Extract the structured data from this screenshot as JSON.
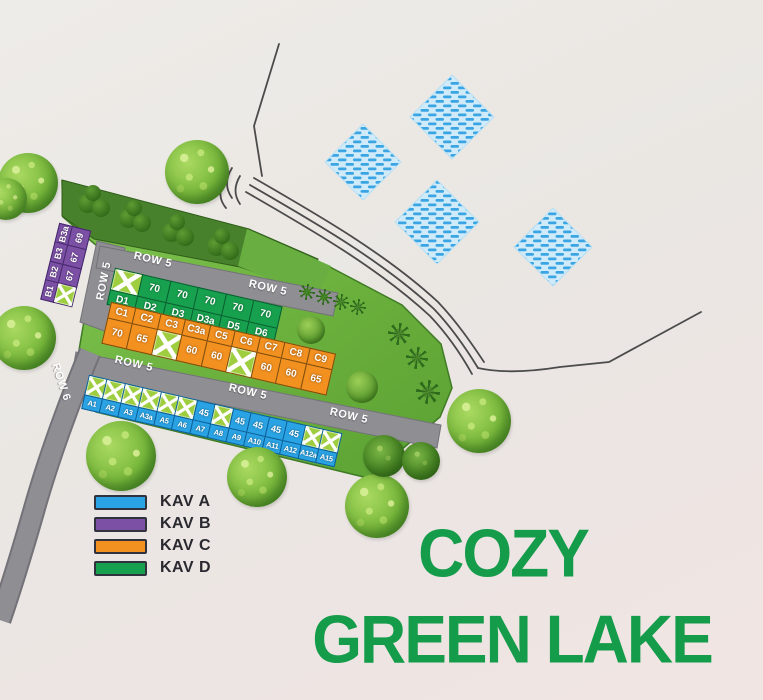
{
  "title": {
    "line1": "COZY",
    "line2": "GREEN LAKE",
    "color": "#159c4b"
  },
  "legend": {
    "items": [
      {
        "label": "KAV A",
        "color": "#2aa3e4"
      },
      {
        "label": "KAV B",
        "color": "#7b50a5"
      },
      {
        "label": "KAV C",
        "color": "#f29020"
      },
      {
        "label": "KAV D",
        "color": "#17a14e"
      }
    ]
  },
  "map": {
    "play_area_label": "AREA BERMAIN",
    "sold_marker": "X",
    "road_labels": [
      {
        "text": "ROW 5"
      },
      {
        "text": "ROW 5"
      },
      {
        "text": "ROW 5"
      },
      {
        "text": "ROW 5"
      },
      {
        "text": "ROW 5"
      },
      {
        "text": "ROW 5"
      },
      {
        "text": "ROW 6"
      }
    ],
    "blocks": {
      "b": {
        "kav": "KAV B",
        "color": "#7b50a5",
        "lots": [
          {
            "name": "B3a",
            "size": "69"
          },
          {
            "name": "B3",
            "size": "67"
          },
          {
            "name": "B2",
            "size": "67"
          },
          {
            "name": "B1",
            "sold": true
          }
        ]
      },
      "d": {
        "kav": "KAV D",
        "color": "#17a14e",
        "lots": [
          {
            "name": "D1",
            "sold": true
          },
          {
            "name": "D2",
            "size": "70"
          },
          {
            "name": "D3",
            "size": "70"
          },
          {
            "name": "D3a",
            "size": "70"
          },
          {
            "name": "D5",
            "size": "70"
          },
          {
            "name": "D6",
            "size": "70"
          }
        ]
      },
      "c": {
        "kav": "KAV C",
        "color": "#f29020",
        "lots": [
          {
            "name": "C1",
            "size": "70"
          },
          {
            "name": "C2",
            "size": "65"
          },
          {
            "name": "C3",
            "sold": true
          },
          {
            "name": "C3a",
            "size": "60"
          },
          {
            "name": "C5",
            "size": "60"
          },
          {
            "name": "C6",
            "sold": true
          },
          {
            "name": "C7",
            "size": "60"
          },
          {
            "name": "C8",
            "size": "60"
          },
          {
            "name": "C9",
            "size": "65"
          }
        ]
      },
      "a": {
        "kav": "KAV A",
        "color": "#2aa3e4",
        "lots": [
          {
            "name": "A1",
            "sold": true
          },
          {
            "name": "A2",
            "sold": true
          },
          {
            "name": "A3",
            "sold": true
          },
          {
            "name": "A3a",
            "sold": true
          },
          {
            "name": "A5",
            "sold": true
          },
          {
            "name": "A6",
            "sold": true
          },
          {
            "name": "A7",
            "size": "45"
          },
          {
            "name": "A8",
            "sold": true
          },
          {
            "name": "A9",
            "size": "45"
          },
          {
            "name": "A10",
            "size": "45"
          },
          {
            "name": "A11",
            "size": "45"
          },
          {
            "name": "A12",
            "size": "45"
          },
          {
            "name": "A12a",
            "sold": true
          },
          {
            "name": "A15",
            "sold": true
          }
        ]
      }
    }
  }
}
